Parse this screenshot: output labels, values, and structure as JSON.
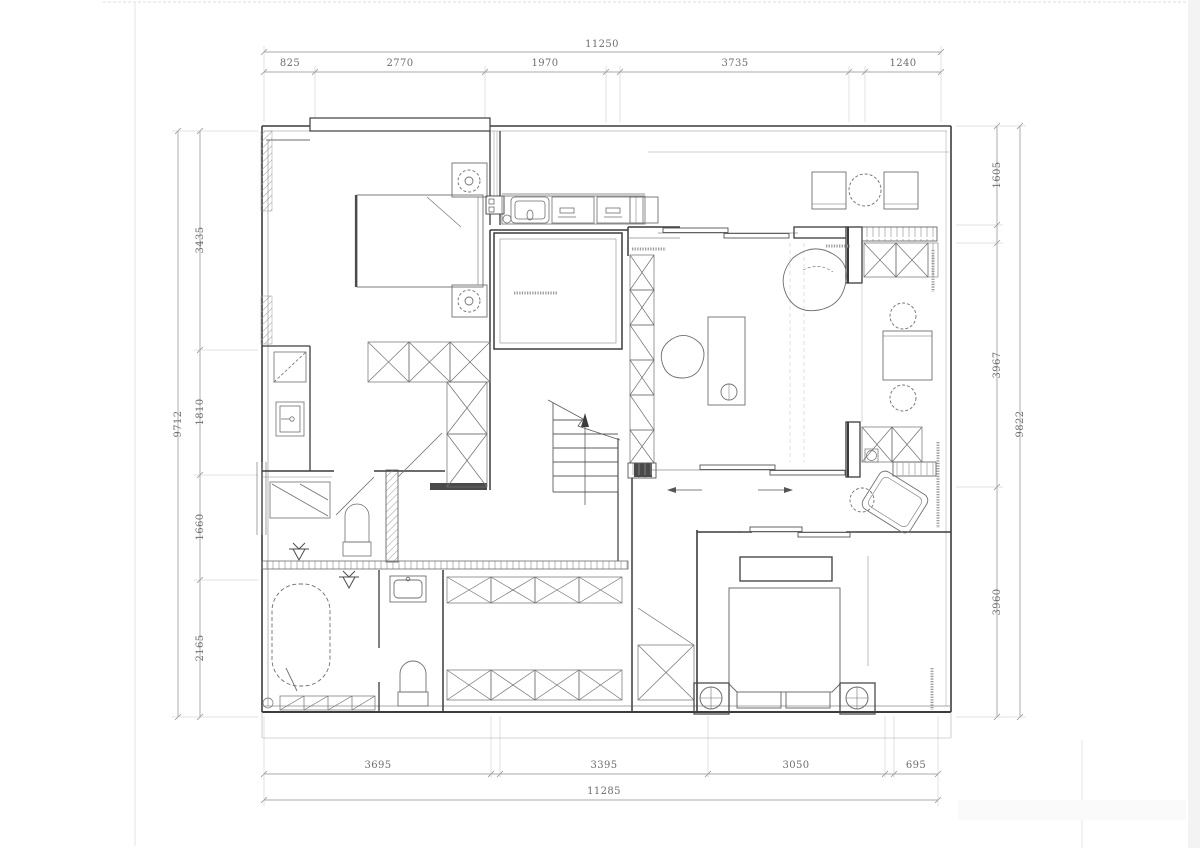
{
  "drawing": {
    "type": "residential floor plan",
    "colors": {
      "paper": "#ffffff",
      "wall": "#3c3c3c",
      "line": "#666666",
      "light": "#9a9a9a",
      "dim": "#8c8c8c",
      "dim_text": "#6e6e6e"
    },
    "dims": {
      "top": {
        "total": "11250",
        "segments": [
          "825",
          "2770",
          "1970",
          "3735",
          "1240"
        ]
      },
      "bottom": {
        "total": "11285",
        "segments": [
          "3695",
          "3395",
          "3050",
          "695"
        ]
      },
      "left": {
        "total": "9712",
        "segments": [
          "3435",
          "1810",
          "1660",
          "2165"
        ]
      },
      "right": {
        "total": "9822",
        "segments": [
          "1605",
          "3967",
          "3960"
        ]
      }
    },
    "icons": {
      "stairs_direction": "up-arrow",
      "sliding_door_arrows": "left-right-arrows",
      "floor_drain": "drain-symbol"
    }
  }
}
